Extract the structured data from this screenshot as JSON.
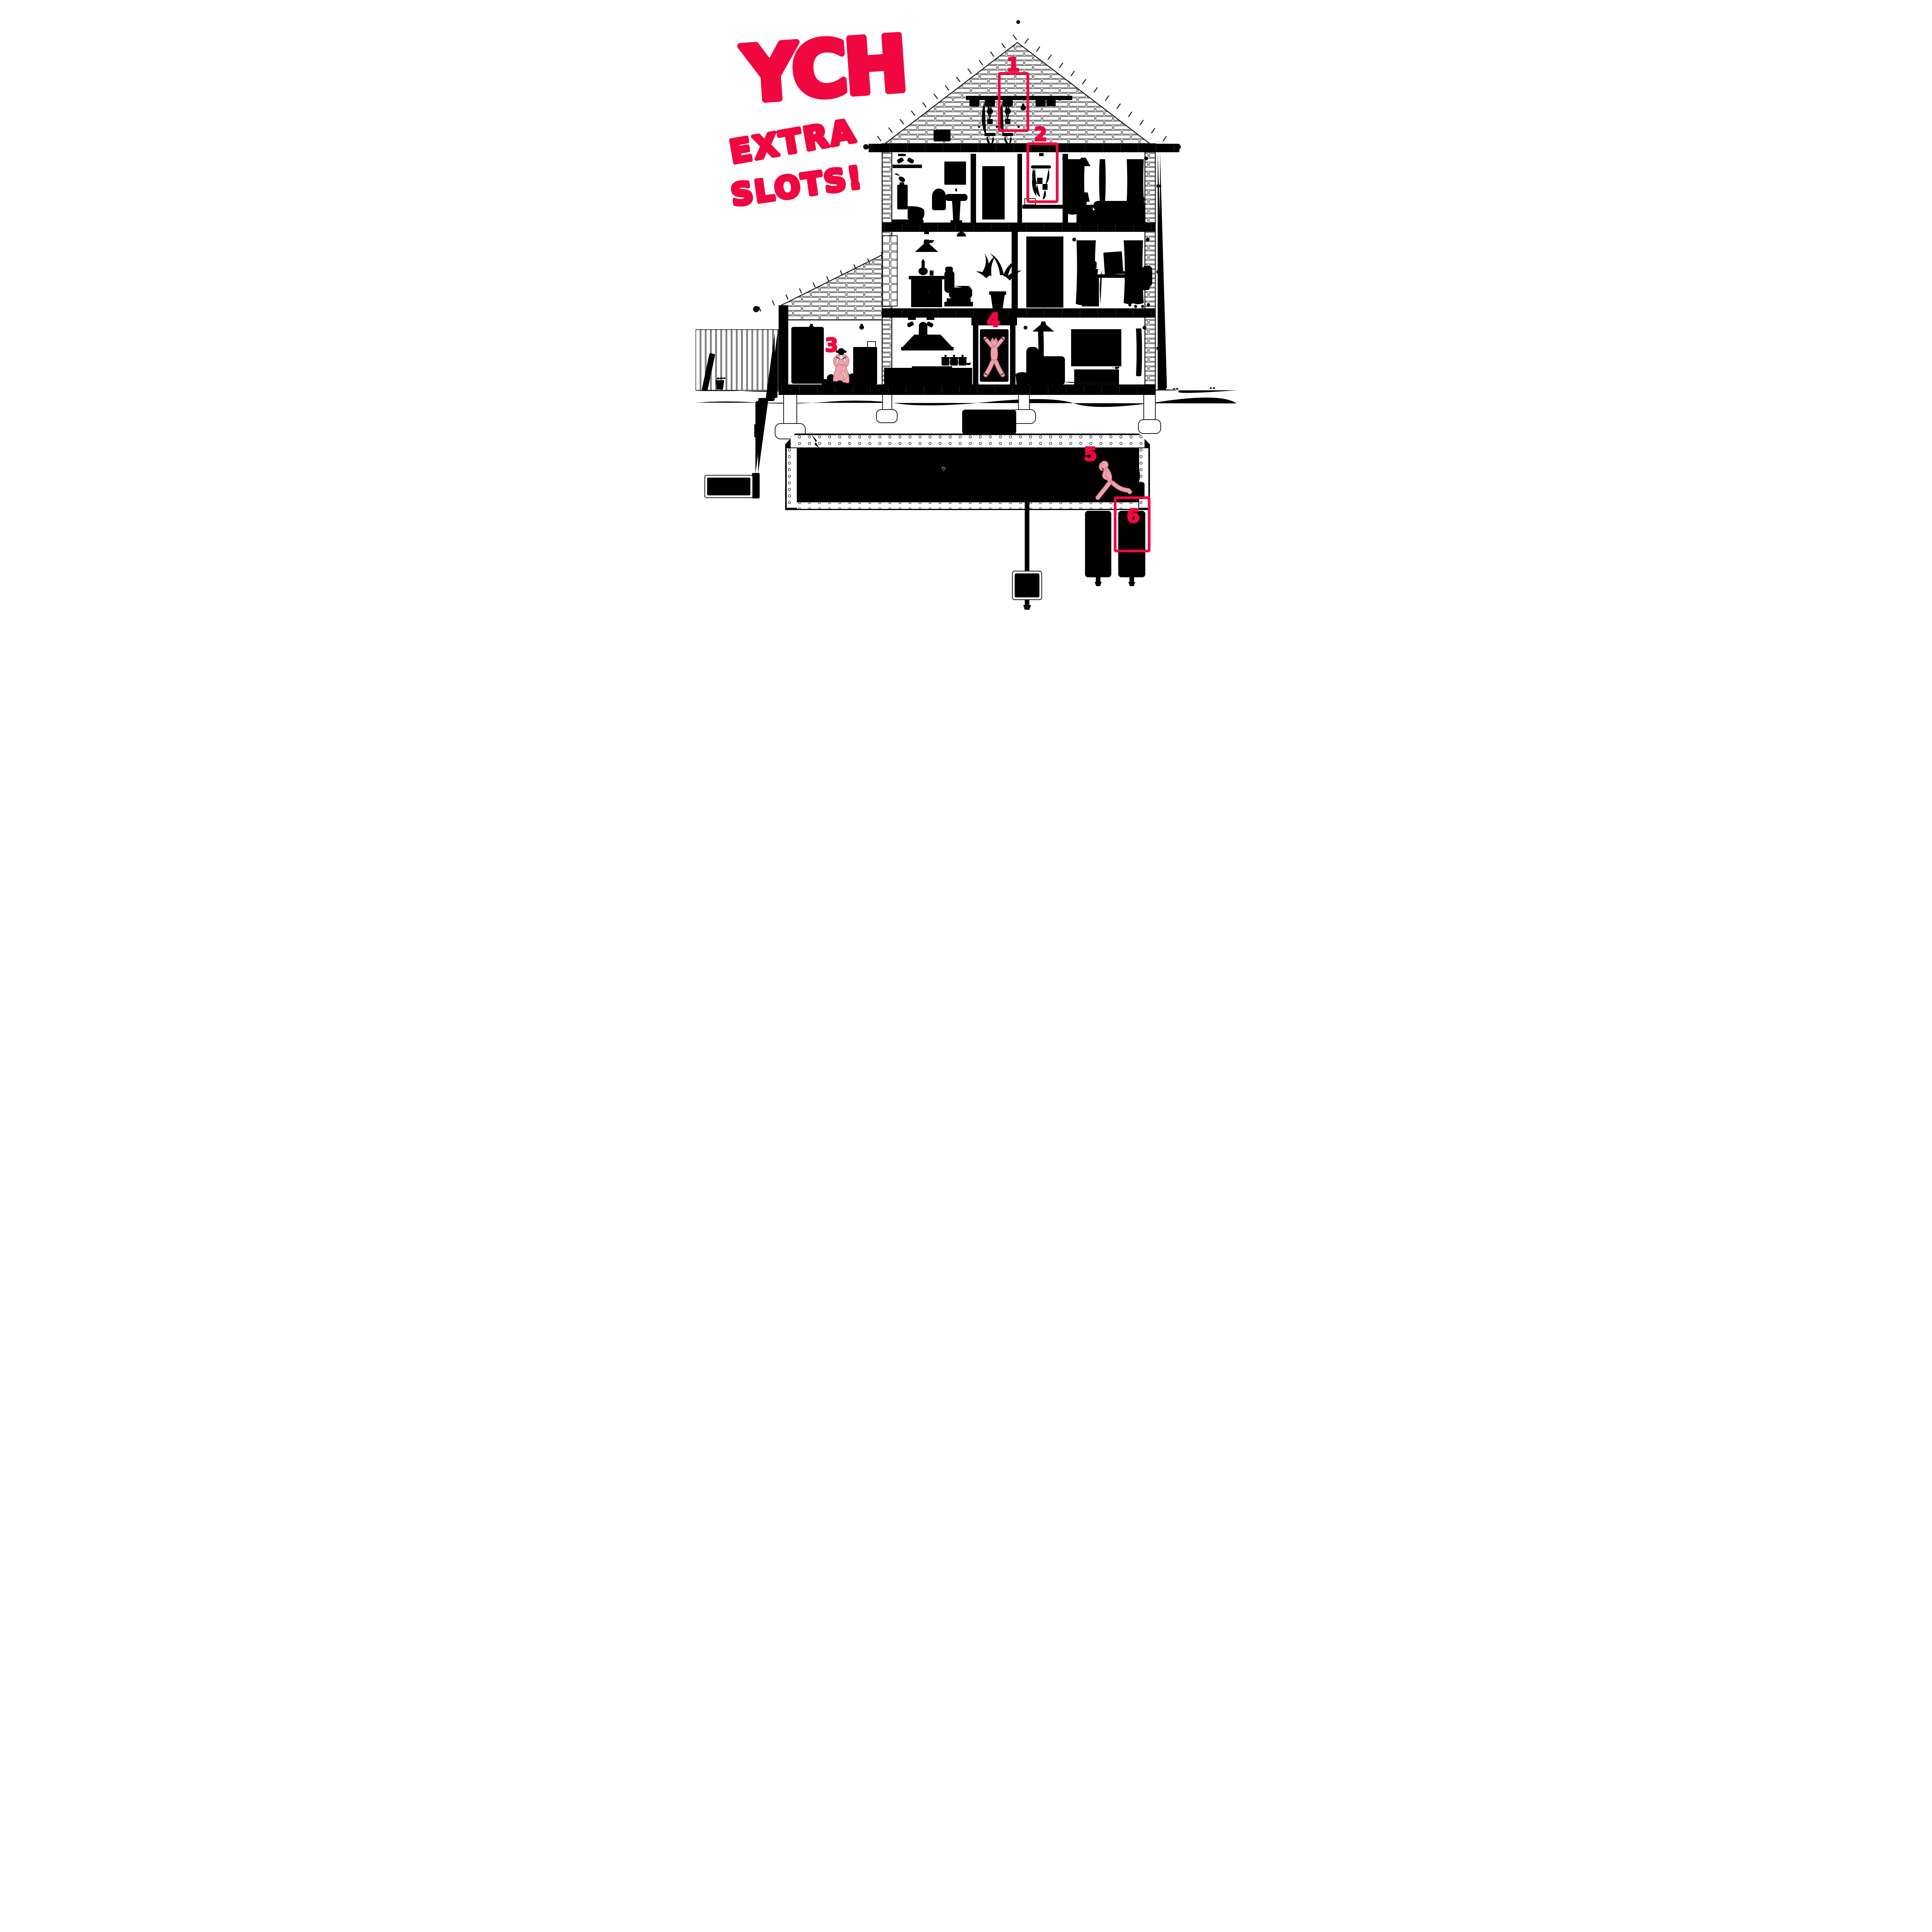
{
  "headline": {
    "title": "YCH",
    "subtitle_line1": "EXTRA",
    "subtitle_line2": "SLOTS!"
  },
  "slots": [
    {
      "number": "1"
    },
    {
      "number": "2"
    },
    {
      "number": "3"
    },
    {
      "number": "4"
    },
    {
      "number": "5"
    },
    {
      "number": "6"
    }
  ],
  "colors": {
    "red": "#f1073f",
    "pink": "#eea3ac",
    "pink_outline": "#c8727e",
    "line": "#1c1c1c",
    "paper": "#ffffff"
  }
}
